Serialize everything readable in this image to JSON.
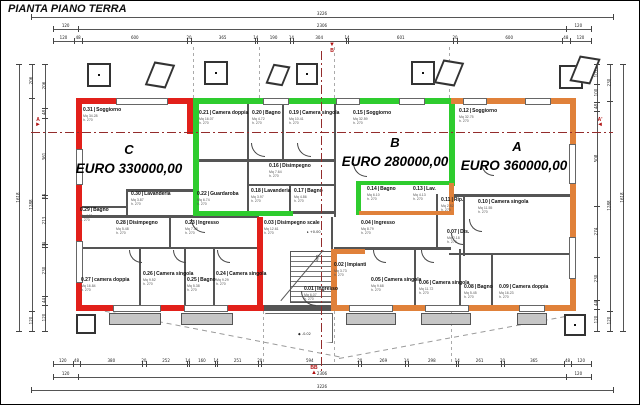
{
  "title": "PIANTA PIANO TERRA",
  "colors": {
    "apartment_a": "#e0813a",
    "apartment_b": "#2ecc2e",
    "apartment_c": "#e2201a",
    "wall": "#3a3a3a",
    "section_line": "#942c2c"
  },
  "apartments": {
    "c": {
      "label": "C",
      "price": "EURO 330000,00",
      "color": "#e2201a"
    },
    "b": {
      "label": "B",
      "price": "EURO 280000,00",
      "color": "#2ecc2e"
    },
    "a": {
      "label": "A",
      "price": "EURO 360000,00",
      "color": "#e0813a"
    }
  },
  "rooms": [
    {
      "n": "0.31",
      "name": "Soggiorno",
      "mq": "Mq 34.28",
      "h": "h. 270",
      "x": 82,
      "y": 107
    },
    {
      "n": "0.30",
      "name": "Lavanderia",
      "mq": "Mq 3.87",
      "h": "h. 270",
      "x": 130,
      "y": 191
    },
    {
      "n": "0.29",
      "name": "Bagno",
      "mq": "Mq 4.31",
      "h": "h. 270",
      "x": 79,
      "y": 207
    },
    {
      "n": "0.28",
      "name": "Disimpegno",
      "mq": "Mq 5.48",
      "h": "h. 270",
      "x": 115,
      "y": 220
    },
    {
      "n": "0.23",
      "name": "Ingresso",
      "mq": "Mq 7.38",
      "h": "h. 270",
      "x": 184,
      "y": 220
    },
    {
      "n": "0.27",
      "name": "camera doppia",
      "mq": "Mq 16.84",
      "h": "h. 270",
      "x": 80,
      "y": 277
    },
    {
      "n": "0.26",
      "name": "Camera singola",
      "mq": "Mq 9.52",
      "h": "h. 270",
      "x": 142,
      "y": 271
    },
    {
      "n": "0.25",
      "name": "Bagno",
      "mq": "Mq 5.38",
      "h": "h. 270",
      "x": 186,
      "y": 277
    },
    {
      "n": "0.24",
      "name": "Camera singola",
      "mq": "Mq 9.29",
      "h": "h. 270",
      "x": 215,
      "y": 271
    },
    {
      "n": "0.21",
      "name": "Camera doppia",
      "mq": "Mq 16.07",
      "h": "h. 270",
      "x": 198,
      "y": 110
    },
    {
      "n": "0.20",
      "name": "Bagno",
      "mq": "Mq 4.72",
      "h": "h. 270",
      "x": 251,
      "y": 110
    },
    {
      "n": "0.19",
      "name": "Camera singola",
      "mq": "Mq 10.41",
      "h": "h. 270",
      "x": 288,
      "y": 110
    },
    {
      "n": "0.15",
      "name": "Soggiorno",
      "mq": "Mq 32.59",
      "h": "h. 270",
      "x": 352,
      "y": 110
    },
    {
      "n": "0.22",
      "name": "Guardaroba",
      "mq": "Mq 6.74",
      "h": "h. 270",
      "x": 196,
      "y": 191
    },
    {
      "n": "0.16",
      "name": "Disimpegno",
      "mq": "Mq 7.64",
      "h": "h. 270",
      "x": 268,
      "y": 163
    },
    {
      "n": "0.18",
      "name": "Lavanderia",
      "mq": "Mq 3.97",
      "h": "h. 270",
      "x": 250,
      "y": 188
    },
    {
      "n": "0.17",
      "name": "Bagno",
      "mq": "Mq 4.86",
      "h": "h. 270",
      "x": 293,
      "y": 188
    },
    {
      "n": "0.14",
      "name": "Bagno",
      "mq": "Mq 6.10",
      "h": "h. 270",
      "x": 366,
      "y": 186
    },
    {
      "n": "0.13",
      "name": "Lav.",
      "mq": "Mq 4.13",
      "h": "h. 270",
      "x": 412,
      "y": 186
    },
    {
      "n": "0.12",
      "name": "Soggiorno",
      "mq": "Mq 32.75",
      "h": "h. 270",
      "x": 458,
      "y": 108
    },
    {
      "n": "0.11",
      "name": "Rip.",
      "mq": "Mq 2.52",
      "h": "h. 270",
      "x": 440,
      "y": 197
    },
    {
      "n": "0.10",
      "name": "Camera singola",
      "mq": "Mq 11.55",
      "h": "h. 270",
      "x": 477,
      "y": 199
    },
    {
      "n": "0.04",
      "name": "Ingresso",
      "mq": "Mq 8.79",
      "h": "h. 270",
      "x": 360,
      "y": 220
    },
    {
      "n": "0.07",
      "name": "Dis.",
      "mq": "Mq 2.18",
      "h": "h. 270",
      "x": 446,
      "y": 229
    },
    {
      "n": "0.05",
      "name": "Camera singola",
      "mq": "Mq 9.68",
      "h": "h. 270",
      "x": 370,
      "y": 277
    },
    {
      "n": "0.06",
      "name": "Camera singola",
      "mq": "Mq 11.72",
      "h": "h. 270",
      "x": 418,
      "y": 280
    },
    {
      "n": "0.08",
      "name": "Bagno",
      "mq": "Mq 5.45",
      "h": "h. 270",
      "x": 463,
      "y": 284
    },
    {
      "n": "0.09",
      "name": "Camera doppia",
      "mq": "Mq 16.23",
      "h": "h. 270",
      "x": 498,
      "y": 284
    },
    {
      "n": "0.03",
      "name": "Disimpegno scale",
      "mq": "Mq 12.61",
      "h": "h. 270",
      "x": 263,
      "y": 220
    },
    {
      "n": "0.02",
      "name": "Impianti",
      "mq": "Mq 3.73",
      "h": "h. 270",
      "x": 333,
      "y": 262
    },
    {
      "n": "0.01",
      "name": "Ingresso",
      "mq": "Mq 6.07",
      "h": "h. 270",
      "x": 303,
      "y": 286
    }
  ],
  "levels": {
    "entry": "+0.00",
    "outside": "-0.02",
    "stair_rise": "480"
  },
  "sections": {
    "left": "A",
    "right": "A'",
    "bottom": "BB",
    "top": "B"
  },
  "dimensions": {
    "top_total_outer": [
      "3226"
    ],
    "top_total_inner": [
      "120",
      "2306",
      "120"
    ],
    "top_segments": [
      "120",
      "48",
      "600",
      "20",
      "365",
      "14",
      "190",
      "14",
      "304",
      "14",
      "601",
      "20",
      "600",
      "48",
      "120"
    ],
    "bottom_segments": [
      "120",
      "48",
      "380",
      "20",
      "252",
      "14",
      "160",
      "14",
      "251",
      "20",
      "594",
      "20",
      "269",
      "14",
      "298",
      "14",
      "261",
      "20",
      "365",
      "48",
      "120"
    ],
    "bottom_total_inner": [
      "120",
      "2306",
      "120"
    ],
    "bottom_total_outer": [
      "3226"
    ],
    "left_inner": [
      "206",
      "48",
      "361",
      "14",
      "213",
      "14",
      "230",
      "44",
      "120"
    ],
    "left_outer": [
      "206",
      "1288",
      "120"
    ],
    "left_total": [
      "1618"
    ],
    "right_inner": [
      "105",
      "100",
      "48",
      "508",
      "274",
      "230",
      "44",
      "120"
    ],
    "right_outer": [
      "230",
      "1288",
      "120"
    ],
    "right_total": [
      "1618"
    ]
  }
}
